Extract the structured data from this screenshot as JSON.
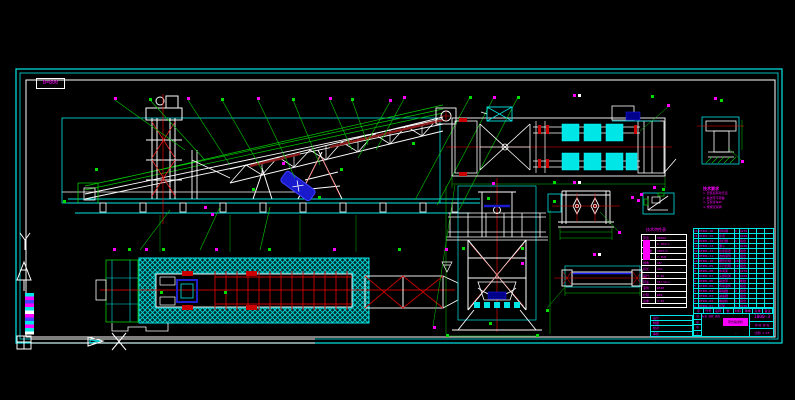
{
  "frame": {
    "corner_label": "B=800"
  },
  "notes": {
    "title": "技术要求",
    "lines": [
      "1.安装后转动灵活",
      "2.输送带不跑偏",
      "3.空载试车2h",
      "4.按规定润滑"
    ]
  },
  "param_table": {
    "title": "技术特性表",
    "rows": [
      [
        "带宽",
        "800mm"
      ],
      [
        "带速",
        "1.25m/s"
      ],
      [
        "输送量",
        "200t/h"
      ],
      [
        "功率",
        "7.5kW"
      ],
      [
        "倾角",
        "18°"
      ],
      [
        "机长",
        "21m"
      ],
      [
        "提升",
        "5.4m"
      ],
      [
        "转速",
        "59r/min"
      ],
      [
        "滚筒",
        "φ500"
      ],
      [
        "托辊",
        "φ89"
      ],
      [
        "总重",
        "3.8t"
      ]
    ]
  },
  "bom": {
    "rows": [
      [
        "16",
        "DTⅡ01-16",
        "导料槽",
        "1",
        "Q235",
        "",
        "",
        ""
      ],
      [
        "15",
        "DTⅡ01-15",
        "护罩",
        "1",
        "Q235",
        "",
        "",
        ""
      ],
      [
        "14",
        "DTⅡ01-14",
        "清扫器",
        "1",
        "组合",
        "",
        "",
        ""
      ],
      [
        "13",
        "DTⅡ01-13",
        "漏斗",
        "1",
        "Q235",
        "",
        "",
        ""
      ],
      [
        "12",
        "DTⅡ01-12",
        "拉紧装置",
        "1",
        "组合",
        "",
        "",
        ""
      ],
      [
        "11",
        "DTⅡ01-11",
        "改向滚筒",
        "1",
        "组合",
        "",
        "",
        ""
      ],
      [
        "10",
        "DTⅡ01-10",
        "槽形托辊",
        "28",
        "组合",
        "",
        "",
        ""
      ],
      [
        "9",
        "DTⅡ01-09",
        "平行托辊",
        "12",
        "组合",
        "",
        "",
        ""
      ],
      [
        "8",
        "DTⅡ01-08",
        "中间架",
        "6",
        "Q235",
        "",
        "",
        ""
      ],
      [
        "7",
        "DTⅡ01-07",
        "头部机架",
        "1",
        "Q235",
        "",
        "",
        ""
      ],
      [
        "6",
        "DTⅡ01-06",
        "输送带",
        "1",
        "橡胶",
        "",
        "",
        ""
      ],
      [
        "5",
        "DTⅡ01-05",
        "传动滚筒",
        "1",
        "组合",
        "",
        "",
        ""
      ],
      [
        "4",
        "DTⅡ01-04",
        "联轴器",
        "2",
        "组合",
        "",
        "",
        ""
      ],
      [
        "3",
        "DTⅡ01-03",
        "减速器",
        "1",
        "组合",
        "",
        "",
        ""
      ],
      [
        "2",
        "DTⅡ01-02",
        "电动机",
        "1",
        "组合",
        "",
        "",
        ""
      ],
      [
        "1",
        "DTⅡ01-01",
        "机架",
        "1",
        "Q235",
        "",
        "",
        ""
      ]
    ],
    "footer": [
      "序",
      "代号",
      "名称",
      "数",
      "材料",
      "单重",
      "总重",
      "备注"
    ]
  },
  "rev_table": {
    "rows": [
      "设计",
      "制图",
      "校对",
      "审核"
    ]
  },
  "title_block": {
    "drawing_no": "1000-3",
    "product": "带式输送机",
    "sheet": "共1张 第1张",
    "scale": "比例 1:25",
    "dash": "-",
    "mid_top": "标记 处数 更改",
    "left_cells": [
      "制",
      "描",
      "审",
      "工"
    ]
  }
}
